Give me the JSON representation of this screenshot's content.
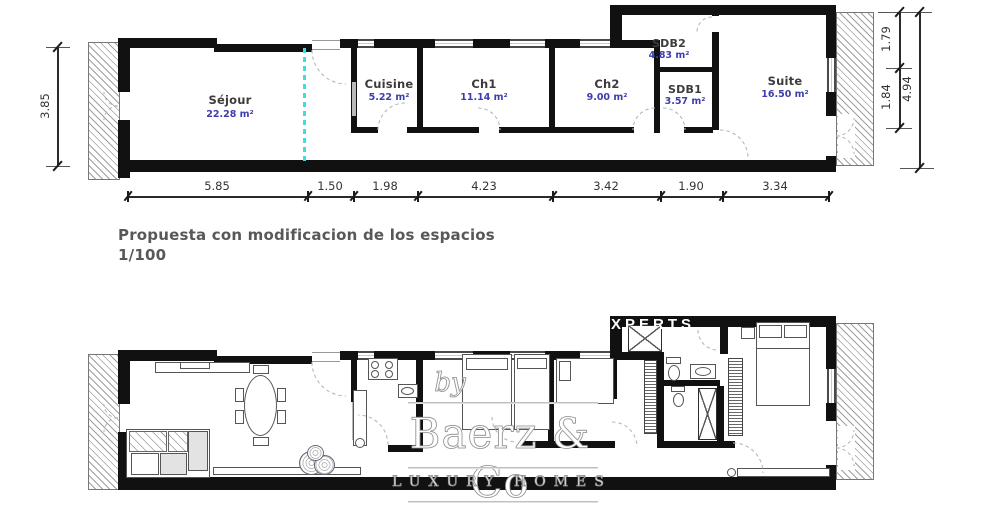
{
  "colors": {
    "wall": "#111111",
    "label": "#3c3c3c",
    "area": "#3d3dae",
    "cyan": "#3fdede",
    "title": "#585858"
  },
  "title": {
    "line1": "Propuesta con modificacion de los espacios",
    "line2": "1/100"
  },
  "top_plan": {
    "rooms": [
      {
        "name": "Séjour",
        "area": "22.28 m²"
      },
      {
        "name": "Cuisine",
        "area": "5.22 m²"
      },
      {
        "name": "Ch1",
        "area": "11.14 m²"
      },
      {
        "name": "Ch2",
        "area": "9.00 m²"
      },
      {
        "name": "SDB2",
        "area": "4.83 m²"
      },
      {
        "name": "SDB1",
        "area": "3.57 m²"
      },
      {
        "name": "Suite",
        "area": "16.50 m²"
      }
    ],
    "dims_bottom": [
      "5.85",
      "1.50",
      "1.98",
      "4.23",
      "3.42",
      "1.90",
      "3.34"
    ],
    "dim_left": "3.85",
    "dims_right": [
      "1.79",
      "1.84",
      "4.94"
    ]
  },
  "watermark": {
    "top": "XPERTS",
    "by": "by",
    "brand": "Baerz & Co",
    "tagline": "LUXURY HOMES"
  }
}
